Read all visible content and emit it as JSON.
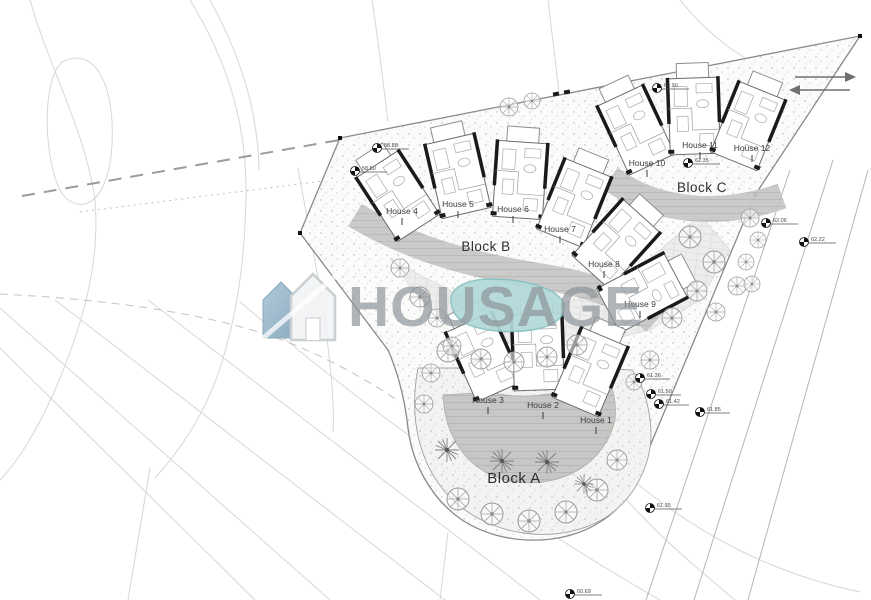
{
  "watermark": {
    "text": "HOUSAGE"
  },
  "blocks": [
    {
      "label": "Block A"
    },
    {
      "label": "Block B"
    },
    {
      "label": "Block C"
    }
  ],
  "houses": [
    {
      "label": "House 1"
    },
    {
      "label": "House 2"
    },
    {
      "label": "House 3"
    },
    {
      "label": "House 4"
    },
    {
      "label": "House 5"
    },
    {
      "label": "House 6"
    },
    {
      "label": "House 7"
    },
    {
      "label": "House 8"
    },
    {
      "label": "House 9"
    },
    {
      "label": "House 10"
    },
    {
      "label": "House 11"
    },
    {
      "label": "House 12"
    }
  ],
  "spot_levels": [
    "58.88",
    "58.50",
    "62.90",
    "62.35",
    "62.06",
    "62.22",
    "61.36",
    "61.50",
    "61.42",
    "61.85",
    "61.35",
    "60.69"
  ],
  "colors": {
    "pool": "#b2d9d9",
    "pool_edge": "#86bfc0",
    "terrace": "#c7c7c5",
    "logo_blue": "#8fb3c7",
    "watermark_text": "#8e959c"
  }
}
